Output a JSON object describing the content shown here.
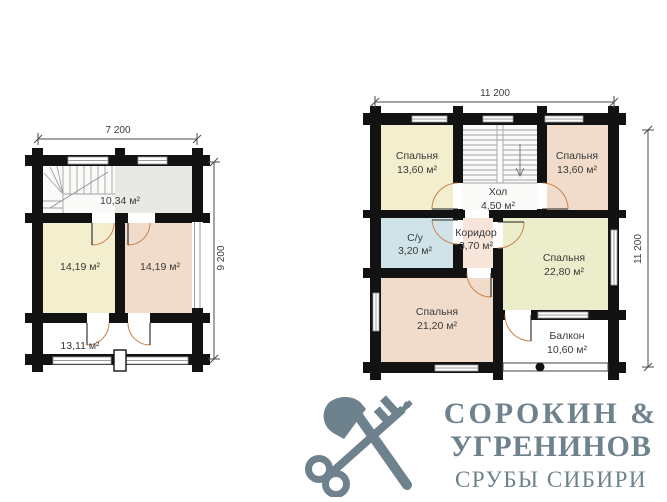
{
  "plans": {
    "first": {
      "width_dim": "7 200",
      "height_dim": "9 200",
      "hall_area": "10,34 м²",
      "room_left_area": "14,19 м²",
      "room_right_area": "14,19 м²",
      "terrace_area": "13,11 м²"
    },
    "second": {
      "width_dim": "11 200",
      "height_dim": "11 200",
      "bedroom_top_left": {
        "name": "Спальня",
        "area": "13,60 м²"
      },
      "bedroom_top_right": {
        "name": "Спальня",
        "area": "13,60 м²"
      },
      "hall": {
        "name": "Хол",
        "area": "4,50 м²"
      },
      "bathroom": {
        "name": "С/у",
        "area": "3,20 м²"
      },
      "corridor": {
        "name": "Коридор",
        "area": "3,70 м²"
      },
      "bedroom_right": {
        "name": "Спальня",
        "area": "22,80 м²"
      },
      "bedroom_bottom": {
        "name": "Спальня",
        "area": "21,20 м²"
      },
      "balcony": {
        "name": "Балкон",
        "area": "10,60 м²"
      }
    }
  },
  "logo": {
    "line1": "СОРОКИН &",
    "line2": "УГРЕНИНОВ",
    "line3": "СРУБЫ СИБИРИ"
  },
  "colors": {
    "walls": "#121212",
    "room_cream": "#f3eecd",
    "room_pink": "#f1dccb",
    "room_blue": "#cfe3e8",
    "room_corridor": "#f7e5da",
    "room_cream2": "#ecedca",
    "room_gray": "#e8e8e5",
    "stair_white": "#fafaf8",
    "door_arc": "#c9854f",
    "logo": "#6d828c"
  }
}
